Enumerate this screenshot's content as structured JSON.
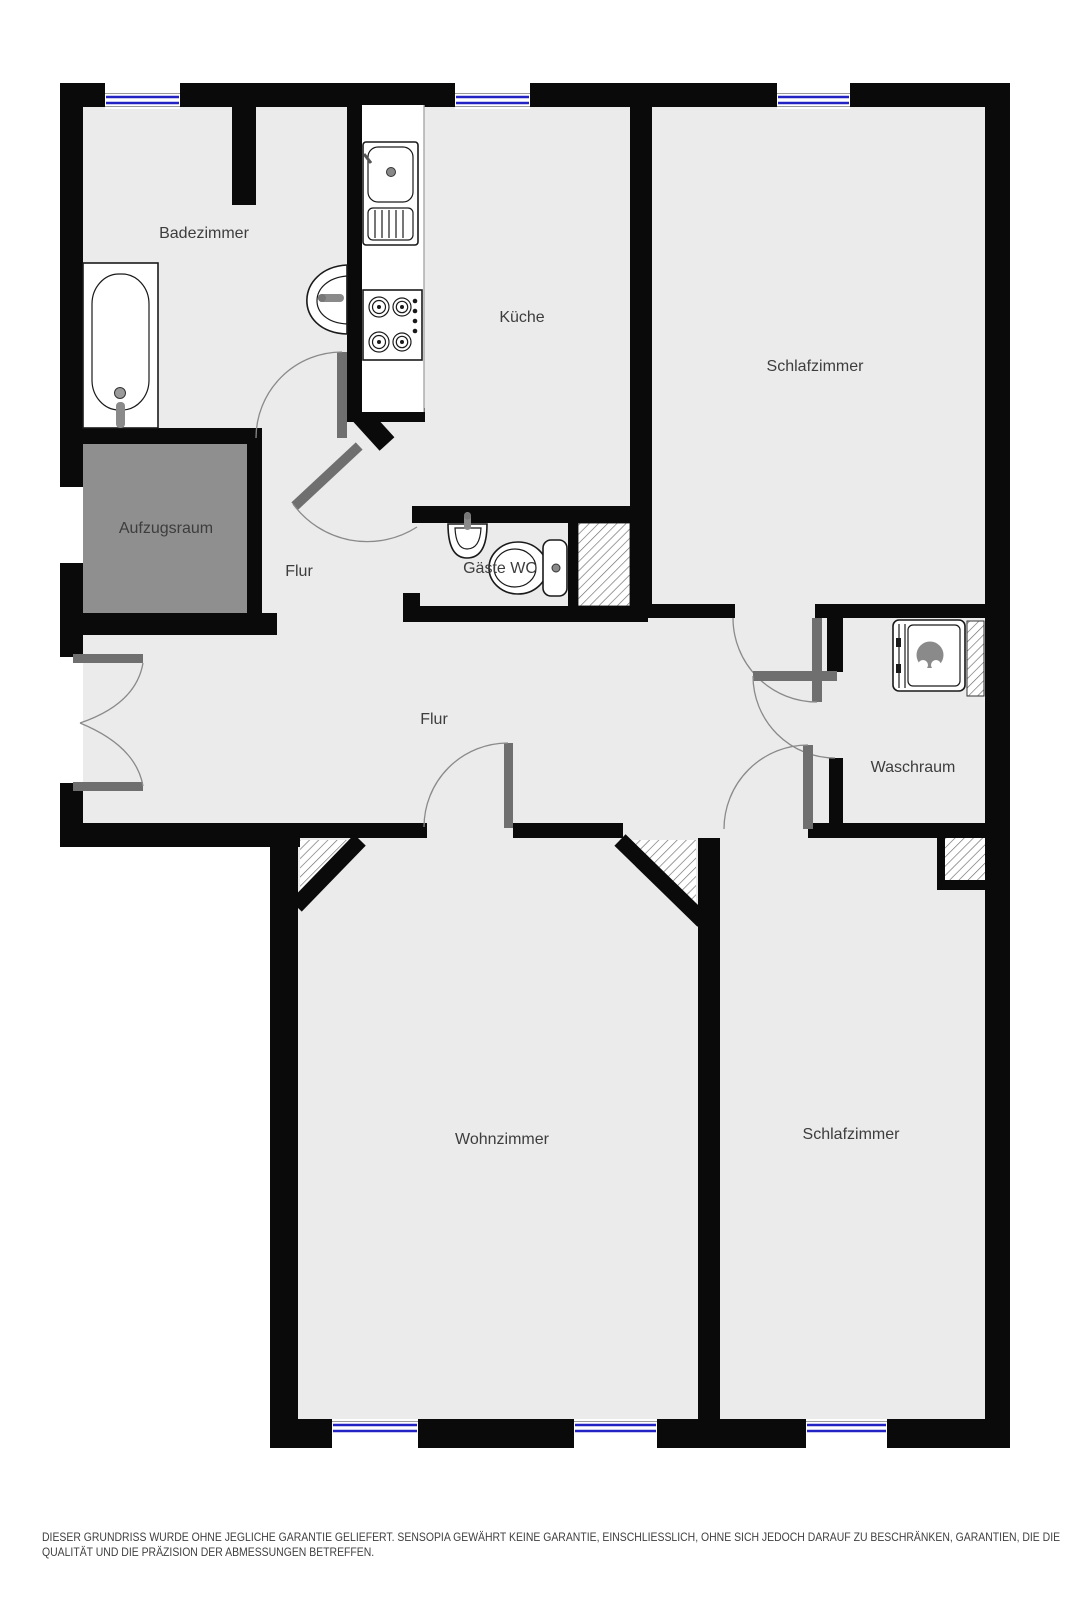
{
  "title": "Grundriss / floor plan",
  "rooms": [
    {
      "id": "badezimmer",
      "label": "Badezimmer"
    },
    {
      "id": "kueche",
      "label": "Küche"
    },
    {
      "id": "schlafzimmer-oben",
      "label": "Schlafzimmer"
    },
    {
      "id": "aufzugsraum",
      "label": "Aufzugsraum"
    },
    {
      "id": "flur-oben",
      "label": "Flur"
    },
    {
      "id": "gaeste-wc",
      "label": "Gäste WC"
    },
    {
      "id": "flur",
      "label": "Flur"
    },
    {
      "id": "waschraum",
      "label": "Waschraum"
    },
    {
      "id": "wohnzimmer",
      "label": "Wohnzimmer"
    },
    {
      "id": "schlafzimmer-unten",
      "label": "Schlafzimmer"
    }
  ],
  "fixtures": [
    "bathtub",
    "wall-basin",
    "kitchen-sink",
    "stove",
    "guest-wc-basin",
    "toilet",
    "washing-machine"
  ],
  "windows": {
    "top": 3,
    "bottom": 3
  },
  "doors": [
    "badezimmer-door",
    "flur-diagonal-door",
    "entrance-double-door",
    "wohnzimmer-door",
    "schlafzimmer-oben-door",
    "waschraum-door",
    "schlafzimmer-unten-door"
  ],
  "disclaimer": {
    "line1": "DIESER GRUNDRISS WURDE OHNE JEGLICHE GARANTIE GELIEFERT. SENSOPIA GEWÄHRT KEINE GARANTIE, EINSCHLIESSLICH, OHNE SICH JEDOCH DARAUF ZU BESCHRÄNKEN, GARANTIEN, DIE DIE",
    "line2": "QUALITÄT UND DIE PRÄZISION DER ABMESSUNGEN BETREFFEN."
  },
  "colors": {
    "wall": "#0a0a0a",
    "floor": "#ebebeb",
    "elevator_fill": "#8f8f8f",
    "door_leaf": "#6f6f6f",
    "window_glass": "#2323c3",
    "label_text": "#3d3d3d",
    "fixture_outline": "#1a1a1a",
    "hatch_line": "#6b6b6b",
    "arc_line": "#8a8a8a",
    "disclaimer_text": "#3f3f3f"
  }
}
